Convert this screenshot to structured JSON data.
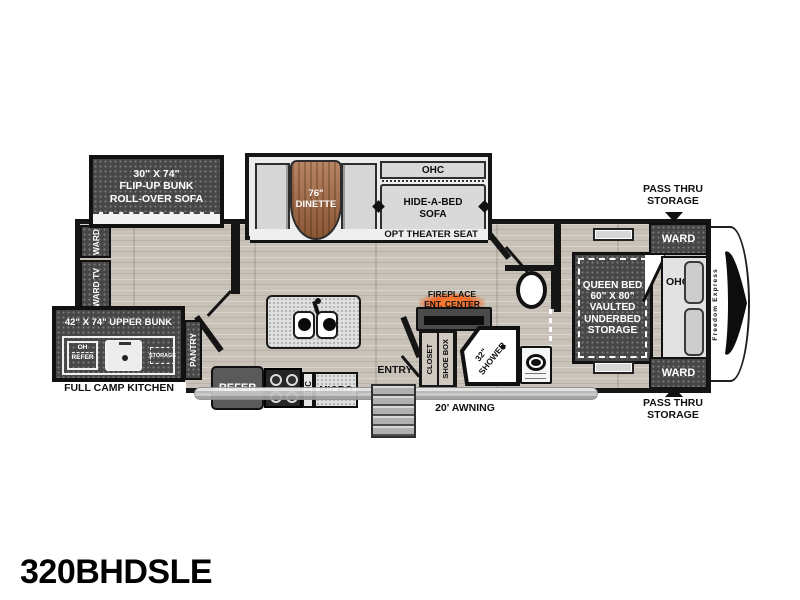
{
  "title": "320BHDSLE",
  "brand_vertical": "Freedom Express",
  "colors": {
    "accent_orange": "#f06a2b",
    "cabinet_dark": "#474747",
    "floor_wood": "#c8c2b8",
    "table_wood": "#a86a41"
  },
  "exterior_labels": {
    "pass_thru_top": "PASS THRU\nSTORAGE",
    "pass_thru_bottom": "PASS THRU\nSTORAGE",
    "awning": "20' AWNING",
    "theater_seat": "OPT THEATER SEAT",
    "camp_kitchen": "FULL CAMP KITCHEN"
  },
  "living": {
    "bunk_slide": "30\" X 74\"\nFLIP-UP BUNK\nROLL-OVER SOFA",
    "dinette": "76\"\nDINETTE",
    "sofa_ohc": "OHC",
    "sofa": "HIDE-A-BED\nSOFA",
    "ward_rear_top": "WARD",
    "ward_rear_tv": "WARD TV"
  },
  "kitchen": {
    "upper_bunk": "42\" X 74\" UPPER BUNK",
    "oh": "OH",
    "oh_refer": "REFER",
    "storage": "STORAGE",
    "pantry": "PANTRY",
    "refer": "REFER",
    "ohc": "OHC",
    "micro": "MICRO",
    "entry": "ENTRY"
  },
  "bath": {
    "fireplace": "FIREPLACE\nENT. CENTER",
    "closet": "CLOSET",
    "shoe_box": "SHOE BOX",
    "shower_size": "32\"",
    "shower": "SHOWER"
  },
  "bedroom": {
    "queen_bed": "QUEEN BED\n60\" X 80\"\nVAULTED\nUNDERBED\nSTORAGE",
    "ward_top": "WARD",
    "ohc": "OHC",
    "ward_bottom": "WARD"
  }
}
